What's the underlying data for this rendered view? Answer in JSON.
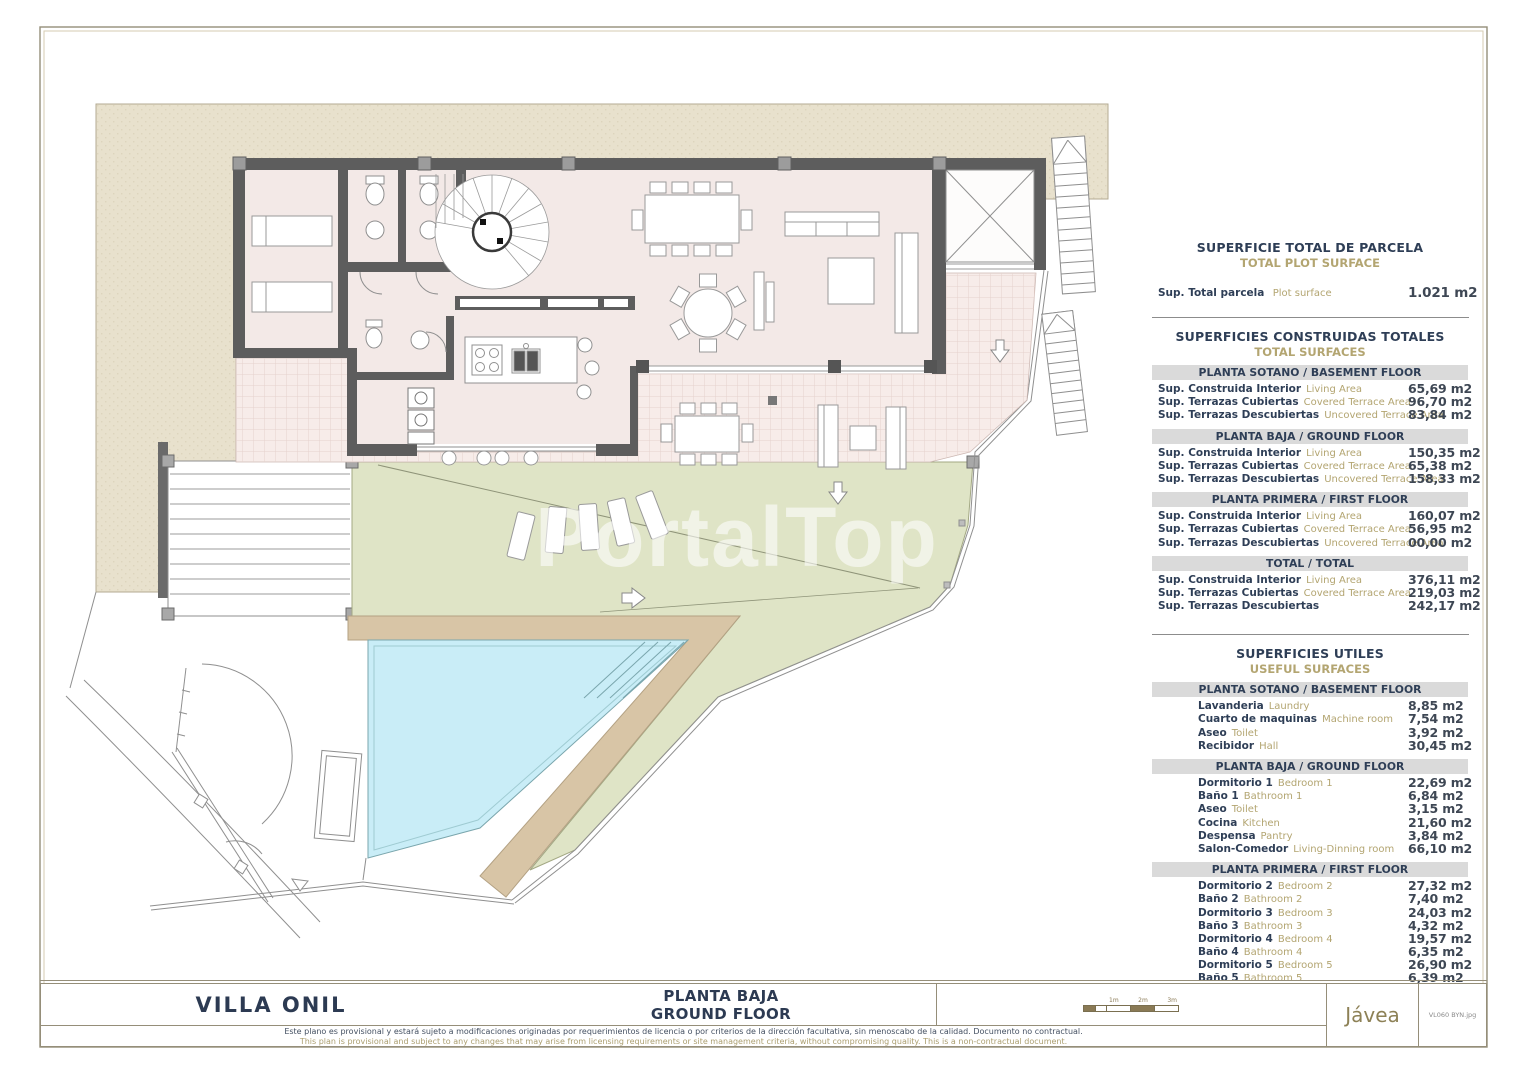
{
  "watermark": "PortalTop",
  "colors": {
    "accent_navy": "#2e3e56",
    "accent_tan": "#b3a571",
    "plot_beige": "#e8e1cd",
    "terrace_pink": "#f7ece9",
    "lawn_green": "#dfe4c6",
    "pool_blue": "#c9edf7",
    "deck_tan": "#d8c5a6",
    "wall_gray": "#5d5d5d",
    "band_gray": "#dadada"
  },
  "panel": {
    "section1": {
      "title": "SUPERFICIE TOTAL DE PARCELA",
      "subtitle": "TOTAL PLOT SURFACE",
      "row": {
        "label": "Sup. Total  parcela",
        "label_en": "Plot surface",
        "value": "1.021 m2"
      }
    },
    "section2": {
      "title": "SUPERFICIES CONSTRUIDAS TOTALES",
      "subtitle": "TOTAL SURFACES",
      "groups": [
        {
          "header": "PLANTA SOTANO / BASEMENT FLOOR",
          "rows": [
            [
              "Sup. Construida Interior",
              "Living Area",
              "65,69 m2"
            ],
            [
              "Sup. Terrazas Cubiertas",
              "Covered Terrace Area",
              "96,70 m2"
            ],
            [
              "Sup. Terrazas Descubiertas",
              "Uncovered Terrace Area",
              "83,84 m2"
            ]
          ]
        },
        {
          "header": "PLANTA BAJA / GROUND FLOOR",
          "rows": [
            [
              "Sup. Construida Interior",
              "Living Area",
              "150,35 m2"
            ],
            [
              "Sup. Terrazas Cubiertas",
              "Covered Terrace Area",
              "65,38 m2"
            ],
            [
              "Sup. Terrazas Descubiertas",
              "Uncovered Terrace Area",
              "158,33 m2"
            ]
          ]
        },
        {
          "header": "PLANTA PRIMERA / FIRST FLOOR",
          "rows": [
            [
              "Sup. Construida Interior",
              "Living Area",
              "160,07 m2"
            ],
            [
              "Sup. Terrazas Cubiertas",
              "Covered Terrace Area",
              "56,95 m2"
            ],
            [
              "Sup. Terrazas Descubiertas",
              "Uncovered Terrace Area",
              "00,00 m2"
            ]
          ]
        },
        {
          "header": "TOTAL / TOTAL",
          "rows": [
            [
              "Sup. Construida Interior",
              "Living Area",
              "376,11 m2"
            ],
            [
              "Sup. Terrazas Cubiertas",
              "Covered Terrace Area",
              "219,03 m2"
            ],
            [
              "Sup. Terrazas Descubiertas",
              "",
              "242,17 m2"
            ]
          ]
        }
      ]
    },
    "section3": {
      "title": "SUPERFICIES UTILES",
      "subtitle": "USEFUL SURFACES",
      "groups": [
        {
          "header": "PLANTA SOTANO / BASEMENT FLOOR",
          "rows": [
            [
              "Lavanderia",
              "Laundry",
              "8,85 m2"
            ],
            [
              "Cuarto de maquinas",
              "Machine room",
              "7,54 m2"
            ],
            [
              "Aseo",
              "Toilet",
              "3,92 m2"
            ],
            [
              "Recibidor",
              "Hall",
              "30,45 m2"
            ]
          ]
        },
        {
          "header": "PLANTA BAJA / GROUND FLOOR",
          "rows": [
            [
              "Dormitorio 1",
              "Bedroom 1",
              "22,69 m2"
            ],
            [
              "Baño 1",
              "Bathroom 1",
              "6,84 m2"
            ],
            [
              "Aseo",
              "Toilet",
              "3,15 m2"
            ],
            [
              "Cocina",
              "Kitchen",
              "21,60 m2"
            ],
            [
              "Despensa",
              "Pantry",
              "3,84 m2"
            ],
            [
              "Salon-Comedor",
              "Living-Dinning room",
              "66,10 m2"
            ]
          ]
        },
        {
          "header": "PLANTA PRIMERA / FIRST FLOOR",
          "rows": [
            [
              "Dormitorio 2",
              "Bedroom 2",
              "27,32 m2"
            ],
            [
              "Baño 2",
              "Bathroom 2",
              "7,40 m2"
            ],
            [
              "Dormitorio 3",
              "Bedroom 3",
              "24,03 m2"
            ],
            [
              "Baño 3",
              "Bathroom 3",
              "4,32 m2"
            ],
            [
              "Dormitorio 4",
              "Bedroom 4",
              "19,57 m2"
            ],
            [
              "Baño 4",
              "Bathroom 4",
              "6,35 m2"
            ],
            [
              "Dormitorio 5",
              "Bedroom 5",
              "26,90 m2"
            ],
            [
              "Baño 5",
              "Bathroom 5",
              "6,39 m2"
            ]
          ]
        }
      ]
    }
  },
  "titleblock": {
    "project": "VILLA ONIL",
    "plan_es": "PLANTA BAJA",
    "plan_en": "GROUND FLOOR",
    "disclaimer_es": "Este plano es provisional y estará sujeto a modificaciones originadas por requerimientos de licencia o por criterios de la dirección facultativa, sin menoscabo de la calidad. Documento no contractual.",
    "disclaimer_en": "This plan is provisional and subject to any changes that may arise from licensing requirements or site management criteria, without compromising quality. This is a non-contractual document.",
    "location": "Jávea",
    "file_ref": "VL060 BYN.jpg",
    "scale_ticks": [
      "1m",
      "2m",
      "3m"
    ]
  }
}
